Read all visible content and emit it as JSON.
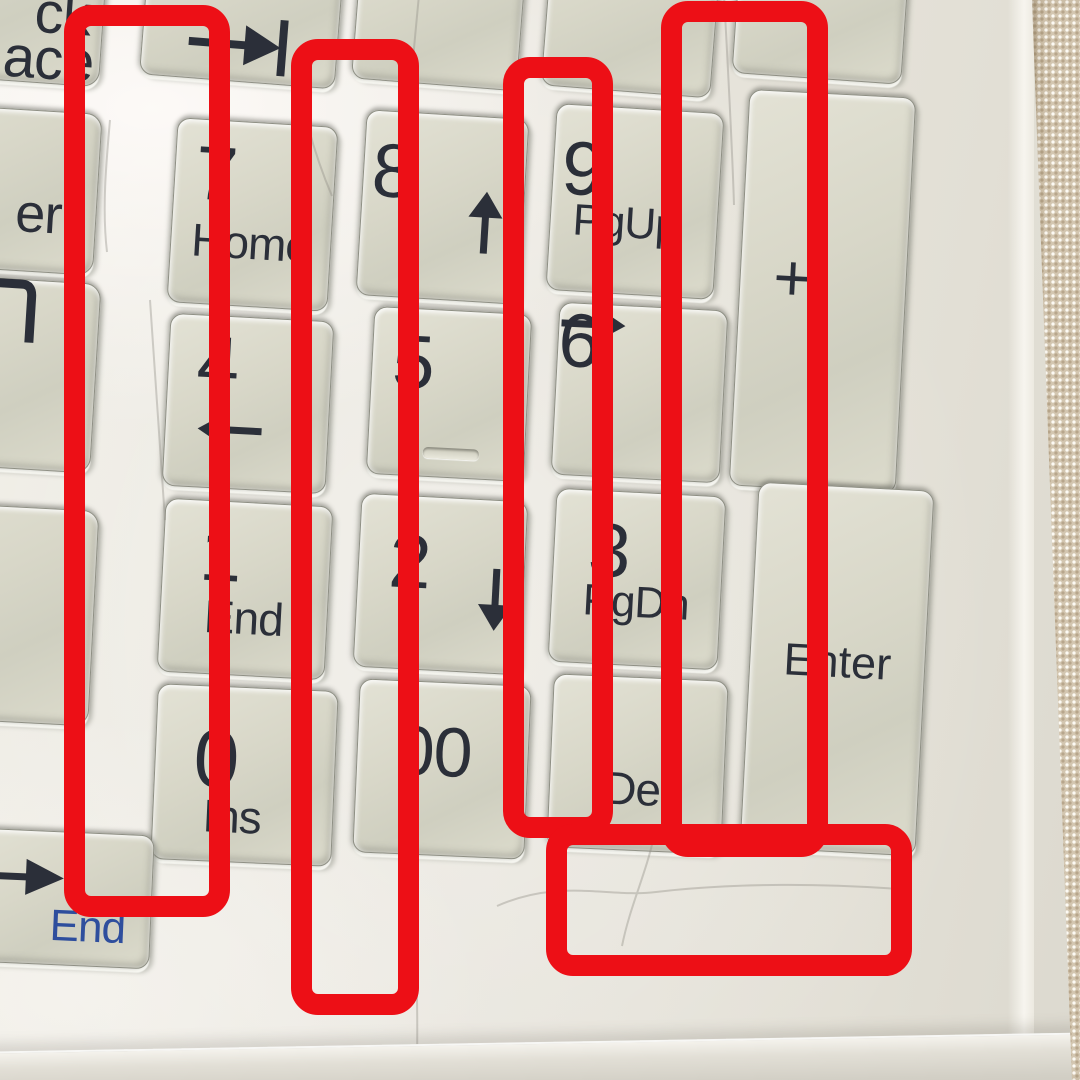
{
  "scene": {
    "description": "Photograph of a white laptop numeric keypad annotated with five red rectangles; beige woven fabric visible along right edge"
  },
  "palette": {
    "annotation_red": "#ed0f16",
    "key_face": "#d8d7c8",
    "key_text": "#2b2f39",
    "fn_label_blue": "#2e4e9d",
    "deck": "#e9e6de",
    "fabric": "#d3c6b0"
  },
  "keys": [
    {
      "name": "key-backspace-fragment",
      "x": -225,
      "y": -92,
      "w": 330,
      "h": 168,
      "rot": 4,
      "main": "ck",
      "sub": "ace",
      "cls": "frag frag-backspace"
    },
    {
      "name": "key-enter-fragment",
      "x": -160,
      "y": 106,
      "w": 258,
      "h": 162,
      "rot": 3.5,
      "main": "er",
      "cls": "frag frag-enter"
    },
    {
      "name": "key-corner-glyph-fragment",
      "x": -160,
      "y": 276,
      "w": 256,
      "h": 190,
      "rot": 3.5,
      "icon": "corner",
      "cls": "frag"
    },
    {
      "name": "key-left-blank-fragment",
      "x": -160,
      "y": 504,
      "w": 254,
      "h": 216,
      "rot": 3,
      "cls": "frag"
    },
    {
      "name": "key-tab",
      "x": 145,
      "y": -78,
      "w": 196,
      "h": 160,
      "rot": 4.5,
      "icon": "tab"
    },
    {
      "name": "key-top-blank-1",
      "x": 357,
      "y": -75,
      "w": 166,
      "h": 160,
      "rot": 4.5
    },
    {
      "name": "key-top-blank-2",
      "x": 547,
      "y": -80,
      "w": 170,
      "h": 172,
      "rot": 4.5
    },
    {
      "name": "key-top-blank-3",
      "x": 737,
      "y": -85,
      "w": 170,
      "h": 164,
      "rot": 4
    },
    {
      "name": "key-7-home",
      "x": 172,
      "y": 122,
      "w": 161,
      "h": 185,
      "rot": 3.5,
      "main": "7",
      "sub": "Home"
    },
    {
      "name": "key-8-up",
      "x": 361,
      "y": 114,
      "w": 163,
      "h": 186,
      "rot": 3.5,
      "main": "8",
      "arrow_glyph": "↑",
      "arrow_dir": "up"
    },
    {
      "name": "key-9-pgup",
      "x": 551,
      "y": 108,
      "w": 168,
      "h": 187,
      "rot": 3.5,
      "main": "9",
      "sub": "PgUp"
    },
    {
      "name": "key-plus",
      "x": 739,
      "y": 93,
      "w": 167,
      "h": 397,
      "rot": 3,
      "main": "+"
    },
    {
      "name": "key-4-left",
      "x": 166,
      "y": 317,
      "w": 164,
      "h": 173,
      "rot": 3,
      "main": "4",
      "arrow_glyph": "←",
      "arrow_dir": "left"
    },
    {
      "name": "key-5",
      "x": 370,
      "y": 310,
      "w": 158,
      "h": 168,
      "rot": 3,
      "main": "5",
      "cls": "has-tactile"
    },
    {
      "name": "key-6-right",
      "x": 555,
      "y": 306,
      "w": 169,
      "h": 173,
      "rot": 3,
      "main": "6",
      "arrow_glyph": "→",
      "arrow_dir": "right"
    },
    {
      "name": "key-1-end",
      "x": 161,
      "y": 502,
      "w": 168,
      "h": 174,
      "rot": 3,
      "main": "1",
      "sub": "End"
    },
    {
      "name": "key-2-down",
      "x": 357,
      "y": 497,
      "w": 167,
      "h": 174,
      "rot": 3,
      "main": "2",
      "arrow_glyph": "↓",
      "arrow_dir": "down"
    },
    {
      "name": "key-3-pgdn",
      "x": 552,
      "y": 492,
      "w": 170,
      "h": 174,
      "rot": 3,
      "main": "3",
      "sub": "PgDn"
    },
    {
      "name": "key-enter",
      "x": 749,
      "y": 486,
      "w": 176,
      "h": 366,
      "rot": 3,
      "main": "Enter"
    },
    {
      "name": "key-0-ins",
      "x": 154,
      "y": 687,
      "w": 181,
      "h": 176,
      "rot": 2.5,
      "main": "0",
      "sub": "Ins"
    },
    {
      "name": "key-00",
      "x": 356,
      "y": 682,
      "w": 172,
      "h": 174,
      "rot": 2.5,
      "main": "00"
    },
    {
      "name": "key-dot-del",
      "x": 550,
      "y": 677,
      "w": 175,
      "h": 174,
      "rot": 2.5,
      "sub": "Del"
    },
    {
      "name": "key-right-arrow-end",
      "x": -48,
      "y": 831,
      "w": 200,
      "h": 134,
      "rot": 2.5,
      "arrow_glyph": "→",
      "arrow_dir": "right-long",
      "sub": "End",
      "cls": "fn-blue-sub"
    }
  ],
  "annotations": [
    {
      "name": "annotation-box-1",
      "x": 64,
      "y": 5,
      "w": 166,
      "h": 912,
      "border_px": 21,
      "shape": "rectangle"
    },
    {
      "name": "annotation-box-2",
      "x": 291,
      "y": 39,
      "w": 128,
      "h": 976,
      "border_px": 21,
      "shape": "rectangle"
    },
    {
      "name": "annotation-box-3",
      "x": 503,
      "y": 57,
      "w": 110,
      "h": 781,
      "border_px": 21,
      "shape": "rectangle"
    },
    {
      "name": "annotation-box-4",
      "x": 661,
      "y": 1,
      "w": 167,
      "h": 856,
      "border_px": 21,
      "shape": "rectangle"
    },
    {
      "name": "annotation-box-5",
      "x": 546,
      "y": 824,
      "w": 366,
      "h": 152,
      "border_px": 21,
      "shape": "rectangle"
    }
  ]
}
